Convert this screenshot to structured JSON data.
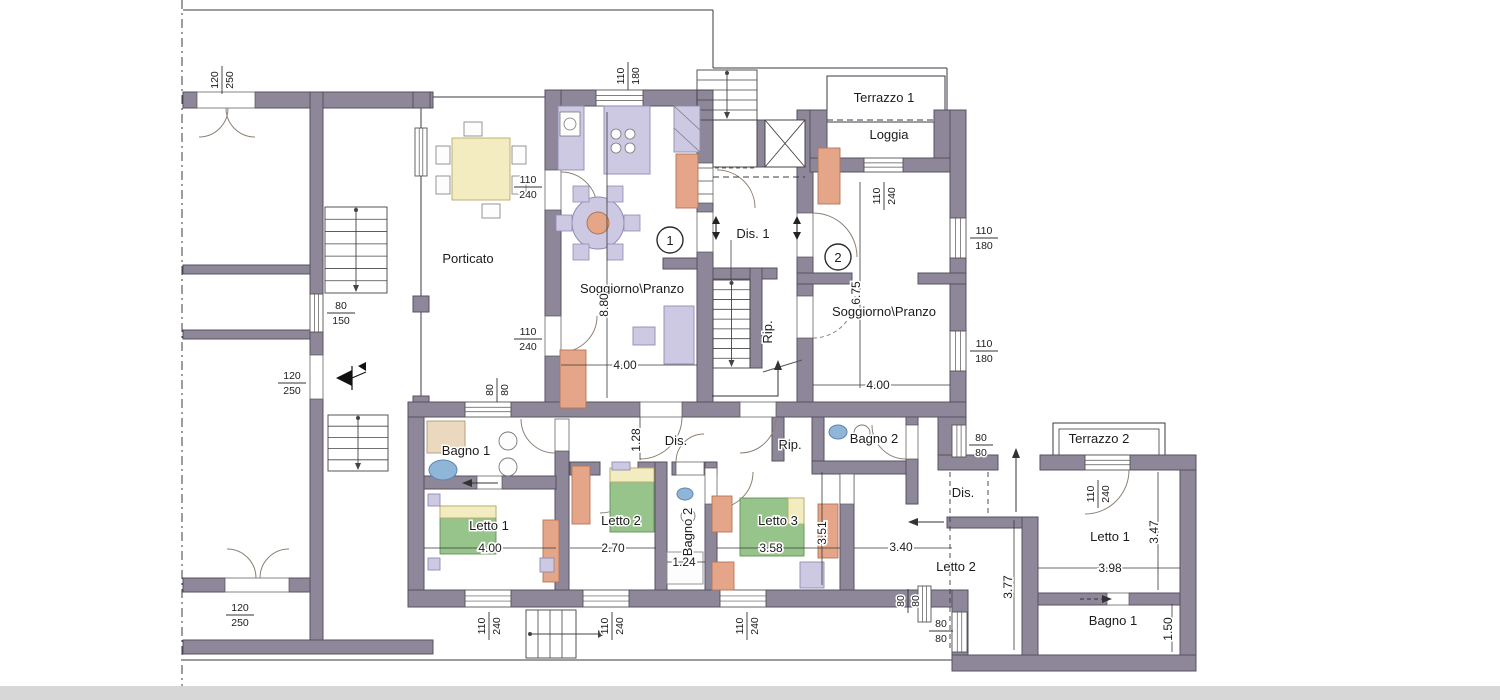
{
  "plan": {
    "rooms": {
      "porticato": "Porticato",
      "soggiorno": "Soggiorno\\Pranzo",
      "dis1": "Dis. 1",
      "dis": "Dis.",
      "rip": "Rip.",
      "loggia": "Loggia",
      "terrazzo1": "Terrazzo 1",
      "terrazzo2": "Terrazzo 2",
      "bagno1": "Bagno 1",
      "bagno2": "Bagno 2",
      "letto1": "Letto 1",
      "letto2": "Letto 2",
      "letto3": "Letto 3"
    },
    "units": {
      "u1": "1",
      "u2": "2"
    },
    "dims": {
      "d880": "8.80",
      "d400": "4.00",
      "d675": "6.75",
      "d128": "1.28",
      "d270": "2.70",
      "d124": "1.24",
      "d358": "3.58",
      "d351": "3.51",
      "d340": "3.40",
      "d377": "3.77",
      "d398": "3.98",
      "d347": "3.47",
      "d150": "1.50"
    },
    "sizes": {
      "s110": "110",
      "s240": "240",
      "s180": "180",
      "s80": "80",
      "s150": "150",
      "s120": "120",
      "s250": "250"
    },
    "colors": {
      "wall": "#8e8799",
      "wall_edge": "#555060",
      "line": "#3d3a42",
      "arc": "#8d8172",
      "lavender": "#cdc9e3",
      "lav_edge": "#8f8bb4",
      "yellow": "#f2ecc0",
      "yel_edge": "#b7a96a",
      "green": "#97c48b",
      "grn_edge": "#639158",
      "salmon": "#e4a588",
      "sal_edge": "#b1765a",
      "blue": "#8fb6d9",
      "blu_edge": "#5f86ab",
      "tan": "#ead9bf",
      "tan_edge": "#b09a72",
      "white_furn": "#fdfdfd",
      "paper": "#ffffff",
      "scan_band": "#d7d7d7"
    }
  }
}
